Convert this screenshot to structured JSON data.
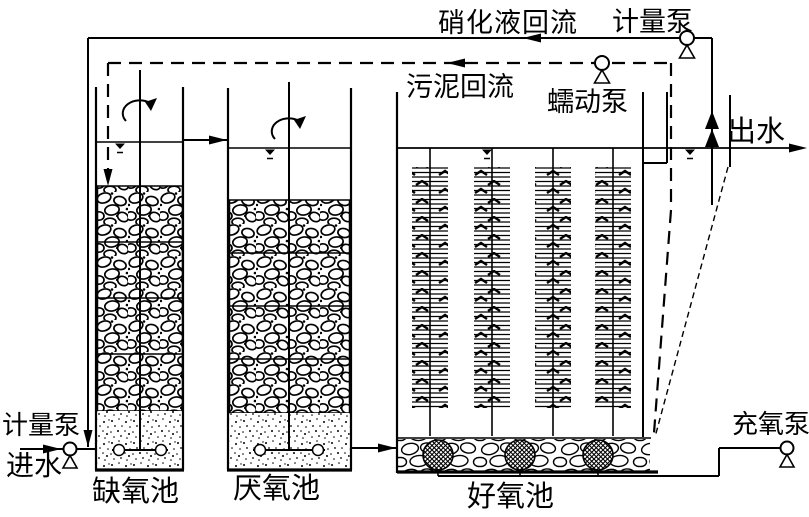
{
  "labels": {
    "nitrified_liquid_return": "硝化液回流",
    "metering_pump_top": "计量泵",
    "sludge_return": "污泥回流",
    "peristaltic_pump": "蠕动泵",
    "effluent": "出水",
    "metering_pump_inlet": "计量泵",
    "influent": "进水",
    "anoxic_tank": "缺氧池",
    "anaerobic_tank": "厌氧池",
    "aerobic_tank": "好氧池",
    "oxygen_pump": "充氧泵"
  },
  "colors": {
    "line": "#000000",
    "background": "#ffffff"
  }
}
